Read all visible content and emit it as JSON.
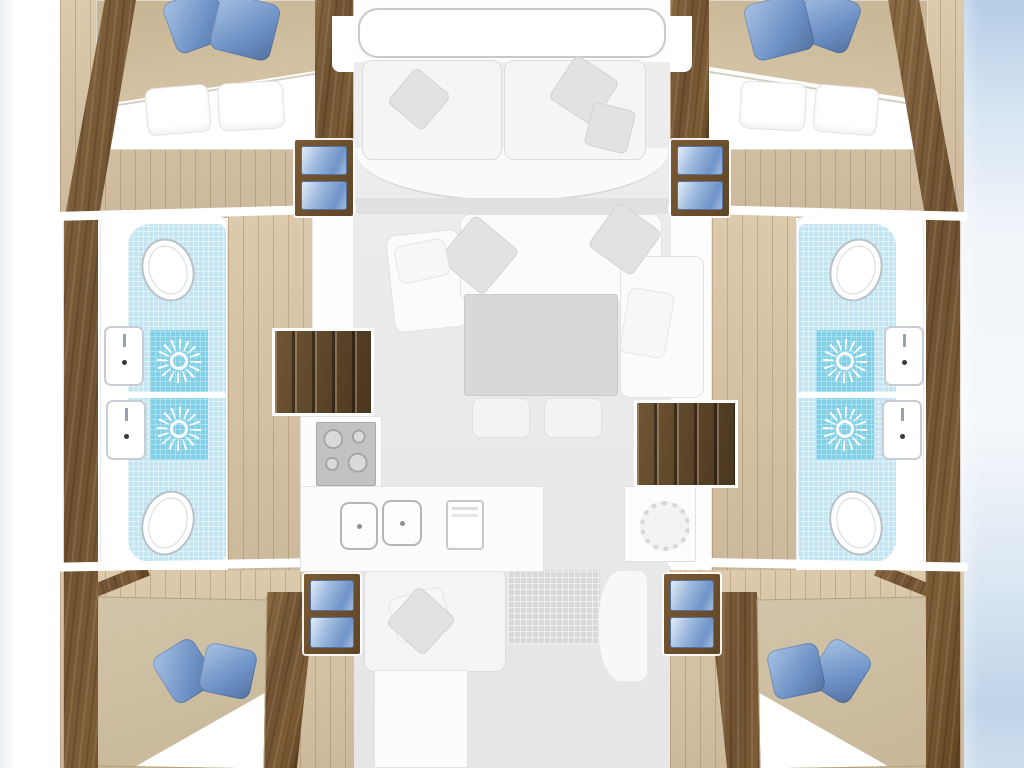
{
  "palette": {
    "wood-a": "#8a6a42",
    "wood-b": "#6f5130",
    "wood-c": "#5e421f",
    "floor": "#d9c4a4",
    "floor-line": "#bfa784",
    "bed-tan-a": "#d2c4a9",
    "bed-tan-b": "#c7b797",
    "bed-head": "#c6b493",
    "pillow-blue-a": "#a9c2e4",
    "pillow-blue-b": "#6d92c6",
    "tile-light": "#c3e5f1",
    "tile-dark": "#82d0e6",
    "fade-bg": "#eeeeee",
    "fade-card": "#f5f5f5",
    "fade-line": "#dcdcdc",
    "fade-pillow": "#e2e2e2",
    "table-gray": "#d8d8d8",
    "steps-a": "#5d4527",
    "steps-b": "#6f5634",
    "water-a": "#b5cde6",
    "water-b": "#bfd4e9",
    "fixture-border": "#b9c2c8"
  },
  "floorplan": {
    "type": "catamaran-interior-deck-plan",
    "areas": [
      "foredeck",
      "forward-cockpit",
      "salon",
      "galley",
      "aft-cockpit",
      "cabin-forward-port",
      "cabin-forward-starboard",
      "cabin-aft-port",
      "cabin-aft-starboard",
      "bathroom-forward-port",
      "bathroom-aft-port",
      "bathroom-forward-starboard",
      "bathroom-aft-starboard",
      "companionway-port",
      "companionway-starboard"
    ],
    "fixtures": [
      {
        "type": "band",
        "name": "aft-deck-path",
        "x": 504,
        "y": 570,
        "w": 98,
        "h": 198
      },
      {
        "type": "mat",
        "name": "aft-deck-mat",
        "x": 508,
        "y": 570,
        "w": 92,
        "h": 74
      },
      {
        "type": "curve",
        "name": "aft-seat-curve",
        "x": 598,
        "y": 570,
        "w": 50,
        "h": 112
      },
      {
        "type": "bench",
        "name": "aft-cockpit-bench",
        "x": 364,
        "y": 568,
        "w": 142,
        "h": 104
      },
      {
        "type": "counter",
        "name": "aft-cockpit-table",
        "x": 374,
        "y": 670,
        "w": 94,
        "h": 98
      },
      {
        "type": "bench",
        "name": "fwd-cockpit-bench-port",
        "x": 362,
        "y": 60,
        "w": 140,
        "h": 100
      },
      {
        "type": "bench",
        "name": "fwd-cockpit-bench-stbd",
        "x": 504,
        "y": 60,
        "w": 142,
        "h": 100
      },
      {
        "type": "pg",
        "name": "cockpit-pillow",
        "x": 396,
        "y": 76,
        "w": 46,
        "h": 46,
        "r": 40
      },
      {
        "type": "pg",
        "name": "cockpit-pillow",
        "x": 558,
        "y": 64,
        "w": 52,
        "h": 52,
        "r": 33
      },
      {
        "type": "pg",
        "name": "cockpit-pillow",
        "x": 588,
        "y": 106,
        "w": 44,
        "h": 44,
        "r": 14
      },
      {
        "type": "sofa",
        "name": "salon-sofa-chaise",
        "x": 390,
        "y": 232,
        "w": 74,
        "h": 98,
        "r": -6
      },
      {
        "type": "sofa",
        "name": "salon-sofa-top",
        "x": 460,
        "y": 214,
        "w": 202,
        "h": 88
      },
      {
        "type": "sofa",
        "name": "salon-sofa-right",
        "x": 620,
        "y": 256,
        "w": 84,
        "h": 142
      },
      {
        "type": "pg",
        "name": "salon-pillow",
        "x": 450,
        "y": 226,
        "w": 58,
        "h": 58,
        "r": 40
      },
      {
        "type": "pg",
        "name": "salon-pillow",
        "x": 598,
        "y": 212,
        "w": 54,
        "h": 54,
        "r": 36
      },
      {
        "type": "pf",
        "name": "salon-pillow",
        "x": 396,
        "y": 242,
        "w": 52,
        "h": 38,
        "r": -12
      },
      {
        "type": "pf",
        "name": "salon-pillow",
        "x": 624,
        "y": 290,
        "w": 46,
        "h": 66,
        "r": 10
      },
      {
        "type": "table",
        "name": "salon-table",
        "x": 464,
        "y": 294,
        "w": 154,
        "h": 102
      },
      {
        "type": "stool",
        "name": "salon-stool",
        "x": 472,
        "y": 398,
        "w": 58,
        "h": 40
      },
      {
        "type": "stool",
        "name": "salon-stool",
        "x": 544,
        "y": 398,
        "w": 58,
        "h": 40
      },
      {
        "type": "counter",
        "name": "galley-counter",
        "x": 300,
        "y": 416,
        "w": 82,
        "h": 156
      },
      {
        "type": "counter",
        "name": "galley-counter",
        "x": 300,
        "y": 486,
        "w": 244,
        "h": 86
      },
      {
        "type": "stove",
        "name": "galley-stove",
        "x": 316,
        "y": 422,
        "w": 60,
        "h": 64
      },
      {
        "type": "gsink",
        "name": "galley-sink",
        "x": 340,
        "y": 502,
        "w": 38,
        "h": 48
      },
      {
        "type": "gsink",
        "name": "galley-sink",
        "x": 382,
        "y": 500,
        "w": 40,
        "h": 46
      },
      {
        "type": "fridge",
        "name": "galley-fridge",
        "x": 446,
        "y": 500,
        "w": 38,
        "h": 50
      },
      {
        "type": "washer",
        "name": "washing-machine",
        "x": 624,
        "y": 486,
        "w": 72,
        "h": 76
      },
      {
        "type": "steps",
        "name": "companionway-steps-port",
        "x": 272,
        "y": 328,
        "w": 102,
        "h": 88
      },
      {
        "type": "steps",
        "name": "companionway-steps-stbd",
        "x": 634,
        "y": 400,
        "w": 104,
        "h": 88
      },
      {
        "type": "drawers",
        "name": "storage-steps-fwd-port",
        "x": 295,
        "y": 140,
        "w": 58,
        "h": 76
      },
      {
        "type": "drawers",
        "name": "storage-steps-fwd-stbd",
        "x": 671,
        "y": 140,
        "w": 58,
        "h": 76
      },
      {
        "type": "drawers",
        "name": "storage-steps-aft-port",
        "x": 304,
        "y": 574,
        "w": 56,
        "h": 80
      },
      {
        "type": "drawers",
        "name": "storage-steps-aft-stbd",
        "x": 664,
        "y": 574,
        "w": 56,
        "h": 80
      },
      {
        "type": "toilet",
        "name": "toilet-fwd-port",
        "x": 142,
        "y": 238,
        "w": 52,
        "h": 64,
        "r": -18
      },
      {
        "type": "toilet",
        "name": "toilet-aft-port",
        "x": 142,
        "y": 490,
        "w": 52,
        "h": 66,
        "r": 18
      },
      {
        "type": "toilet",
        "name": "toilet-fwd-stbd",
        "x": 830,
        "y": 238,
        "w": 52,
        "h": 64,
        "r": 18
      },
      {
        "type": "toilet",
        "name": "toilet-aft-stbd",
        "x": 830,
        "y": 490,
        "w": 52,
        "h": 66,
        "r": -18
      },
      {
        "type": "shower",
        "name": "shower-fwd-port",
        "x": 150,
        "y": 330,
        "w": 58,
        "h": 62
      },
      {
        "type": "shower",
        "name": "shower-aft-port",
        "x": 150,
        "y": 398,
        "w": 58,
        "h": 62
      },
      {
        "type": "shower",
        "name": "shower-fwd-stbd",
        "x": 816,
        "y": 330,
        "w": 58,
        "h": 62
      },
      {
        "type": "shower",
        "name": "shower-aft-stbd",
        "x": 816,
        "y": 398,
        "w": 58,
        "h": 62
      },
      {
        "type": "sink",
        "name": "washbasin-fwd-port",
        "x": 104,
        "y": 326,
        "w": 40,
        "h": 60
      },
      {
        "type": "sink",
        "name": "washbasin-aft-port",
        "x": 106,
        "y": 400,
        "w": 40,
        "h": 60
      },
      {
        "type": "sink",
        "name": "washbasin-fwd-stbd",
        "x": 884,
        "y": 326,
        "w": 40,
        "h": 60
      },
      {
        "type": "sink",
        "name": "washbasin-aft-stbd",
        "x": 882,
        "y": 400,
        "w": 40,
        "h": 60
      },
      {
        "type": "pb",
        "name": "pillow-blue",
        "x": 168,
        "y": -6,
        "w": 56,
        "h": 54,
        "r": -20
      },
      {
        "type": "pb",
        "name": "pillow-blue",
        "x": 214,
        "y": -2,
        "w": 62,
        "h": 58,
        "r": 14
      },
      {
        "type": "pb",
        "name": "pillow-blue",
        "x": 800,
        "y": -6,
        "w": 56,
        "h": 54,
        "r": 20
      },
      {
        "type": "pb",
        "name": "pillow-blue",
        "x": 748,
        "y": -2,
        "w": 62,
        "h": 58,
        "r": -14
      },
      {
        "type": "pw",
        "name": "pillow-white",
        "x": 146,
        "y": 86,
        "w": 64,
        "h": 48,
        "r": -5
      },
      {
        "type": "pw",
        "name": "pillow-white",
        "x": 218,
        "y": 82,
        "w": 66,
        "h": 48,
        "r": -3
      },
      {
        "type": "pw",
        "name": "pillow-white",
        "x": 814,
        "y": 86,
        "w": 64,
        "h": 48,
        "r": 5
      },
      {
        "type": "pw",
        "name": "pillow-white",
        "x": 740,
        "y": 82,
        "w": 66,
        "h": 48,
        "r": 3
      },
      {
        "type": "pf",
        "name": "aft-bench-pillow",
        "x": 392,
        "y": 592,
        "w": 56,
        "h": 46,
        "r": -16
      },
      {
        "type": "pg",
        "name": "aft-bench-pillow",
        "x": 396,
        "y": 596,
        "w": 50,
        "h": 50,
        "r": 42
      },
      {
        "type": "pb",
        "name": "pillow-blue",
        "x": 160,
        "y": 644,
        "w": 48,
        "h": 54,
        "r": -32
      },
      {
        "type": "pb",
        "name": "pillow-blue",
        "x": 202,
        "y": 646,
        "w": 52,
        "h": 50,
        "r": 12
      },
      {
        "type": "pb",
        "name": "pillow-blue",
        "x": 816,
        "y": 644,
        "w": 48,
        "h": 54,
        "r": 32
      },
      {
        "type": "pb",
        "name": "pillow-blue",
        "x": 770,
        "y": 646,
        "w": 52,
        "h": 50,
        "r": -12
      }
    ]
  }
}
